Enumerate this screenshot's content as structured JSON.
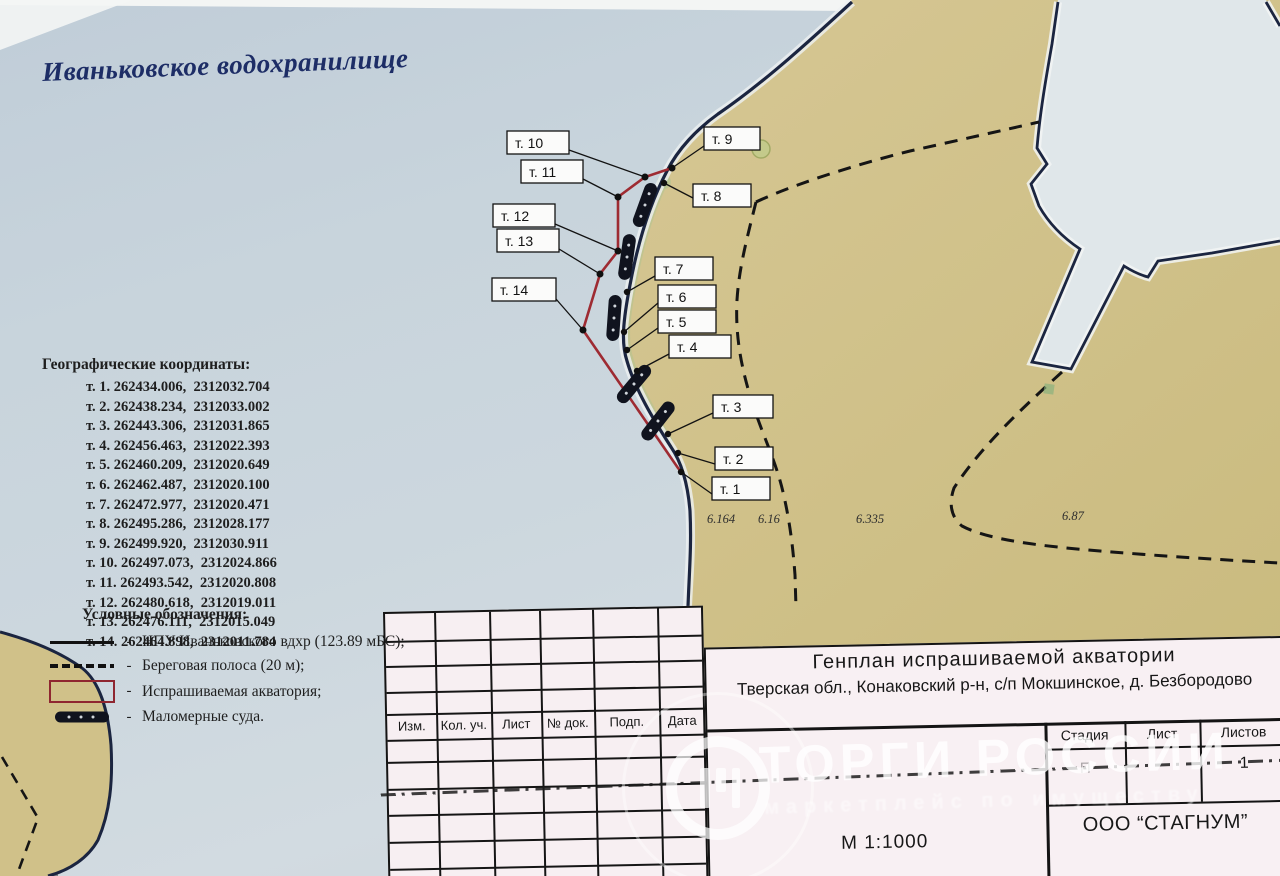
{
  "document": {
    "title": "Иваньковское водохранилище"
  },
  "coordinates": {
    "heading": "Географические координаты:",
    "lines": [
      "т. 1. 262434.006,  2312032.704",
      "т. 2. 262438.234,  2312033.002",
      "т. 3. 262443.306,  2312031.865",
      "т. 4. 262456.463,  2312022.393",
      "т. 5. 262460.209,  2312020.649",
      "т. 6. 262462.487,  2312020.100",
      "т. 7. 262472.977,  2312020.471",
      "т. 8. 262495.286,  2312028.177",
      "т. 9. 262499.920,  2312030.911",
      "т. 10. 262497.073,  2312024.866",
      "т. 11. 262493.542,  2312020.808",
      "т. 12. 262480.618,  2312019.011",
      "т. 13. 262476.111,  2312015.049",
      "т. 14. 262464.898,  2312011.784"
    ]
  },
  "legend": {
    "heading": "Условные обозначения:",
    "separator": "-",
    "items": [
      {
        "swatch": "npu-line",
        "label": "НПУ Иваньковского вдхр (123.89 мБС);"
      },
      {
        "swatch": "shore-strip-line",
        "label": "Береговая полоса (20 м);"
      },
      {
        "swatch": "requested-area",
        "label": "Испрашиваемая акватория;"
      },
      {
        "swatch": "small-boat",
        "label": "Маломерные суда."
      }
    ]
  },
  "map": {
    "point_labels": [
      {
        "text": "т. 1"
      },
      {
        "text": "т. 2"
      },
      {
        "text": "т. 3"
      },
      {
        "text": "т. 4"
      },
      {
        "text": "т. 5"
      },
      {
        "text": "т. 6"
      },
      {
        "text": "т. 7"
      },
      {
        "text": "т. 8"
      },
      {
        "text": "т. 9"
      },
      {
        "text": "т. 10"
      },
      {
        "text": "т. 11"
      },
      {
        "text": "т. 12"
      },
      {
        "text": "т. 13"
      },
      {
        "text": "т. 14"
      }
    ],
    "depth_marks": [
      {
        "text": "6.164"
      },
      {
        "text": "6.16"
      },
      {
        "text": "6.335"
      },
      {
        "text": "6.87"
      }
    ],
    "colors": {
      "water": "#c9d5dd",
      "land": "#cfc088",
      "shoreline": "#1b2540",
      "requested_area_outline": "#9e2b32",
      "boat": "#10131e"
    }
  },
  "stamp": {
    "revision_columns": [
      "Изм.",
      "Кол. уч.",
      "Лист",
      "№ док.",
      "Подп.",
      "Дата"
    ],
    "title_line1": "Генплан испрашиваемой акватории",
    "title_line2": "Тверская обл., Конаковский р-н, с/п Мокшинское, д. Безбородово",
    "stage_label": "Стадия",
    "sheet_label": "Лист",
    "sheets_label": "Листов",
    "stage_value": "П",
    "sheets_value": "1",
    "scale": "М 1:1000",
    "company": "ООО “СТАГНУМ”"
  },
  "watermark": {
    "text": "ТОРГИ РОССИИ",
    "subtitle": "маркетплейс по имуществу"
  }
}
